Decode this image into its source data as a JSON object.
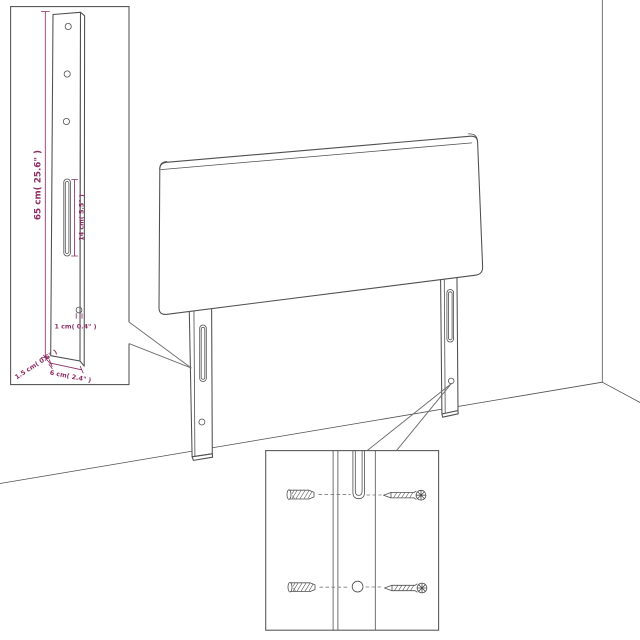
{
  "diagram_type": "headboard-assembly-dimension-diagram",
  "colors": {
    "background": "#ffffff",
    "line": "#4f4f4f",
    "dimension": "#8e2f66",
    "box_border": "#5a5a5a",
    "callout": "#6e6e6e"
  },
  "leg_detail_inset": {
    "labels": {
      "post_height": "65 cm( 25.6\" )",
      "slot_length": "14 cm( 5.5\" )",
      "hole_diameter": "1 cm( 0.4\" )",
      "post_depth": "1.5 cm( 0.6\" )",
      "post_width": "6 cm( 2.4\" )"
    },
    "icons": [
      "mounting-post",
      "screw-hole",
      "keyhole-slot"
    ]
  },
  "mounting_detail_inset": {
    "icons": [
      "wall-plug",
      "screw",
      "keyhole-slot",
      "screw-hole"
    ]
  },
  "main_illustration": {
    "icons": [
      "headboard-panel",
      "left-leg",
      "right-leg",
      "wall-corner",
      "floor-line"
    ]
  }
}
